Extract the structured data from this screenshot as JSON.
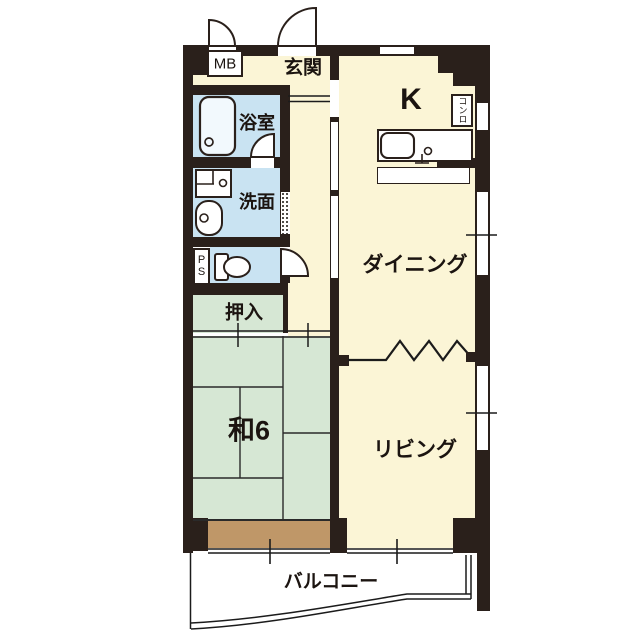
{
  "colors": {
    "wall": "#2a201b",
    "floor_yellow": "#fbf5d6",
    "wet_area_blue": "#c9e3f2",
    "tatami_green": "#d6e7d4",
    "wood_brown": "#bf9768",
    "background": "#ffffff",
    "line": "#1b1b1b"
  },
  "rooms": {
    "meter_box": {
      "label": "MB"
    },
    "entrance": {
      "label": "玄関"
    },
    "kitchen": {
      "label": "K"
    },
    "bathroom": {
      "label": "浴室"
    },
    "washroom": {
      "label": "洗面"
    },
    "pipe_space": {
      "label": "PS"
    },
    "closet": {
      "label": "押入"
    },
    "japanese_room": {
      "label": "和6"
    },
    "dining": {
      "label": "ダイニング"
    },
    "living": {
      "label": "リビング"
    },
    "balcony": {
      "label": "バルコニー"
    }
  },
  "fixtures": {
    "stove": {
      "label": "コンロ"
    },
    "icons": [
      "bathtub-icon",
      "washing-machine-pan-icon",
      "washbasin-icon",
      "toilet-icon",
      "kitchen-sink-icon",
      "door-swing-icon",
      "accordion-door-icon",
      "zigzag-partition-icon"
    ]
  }
}
